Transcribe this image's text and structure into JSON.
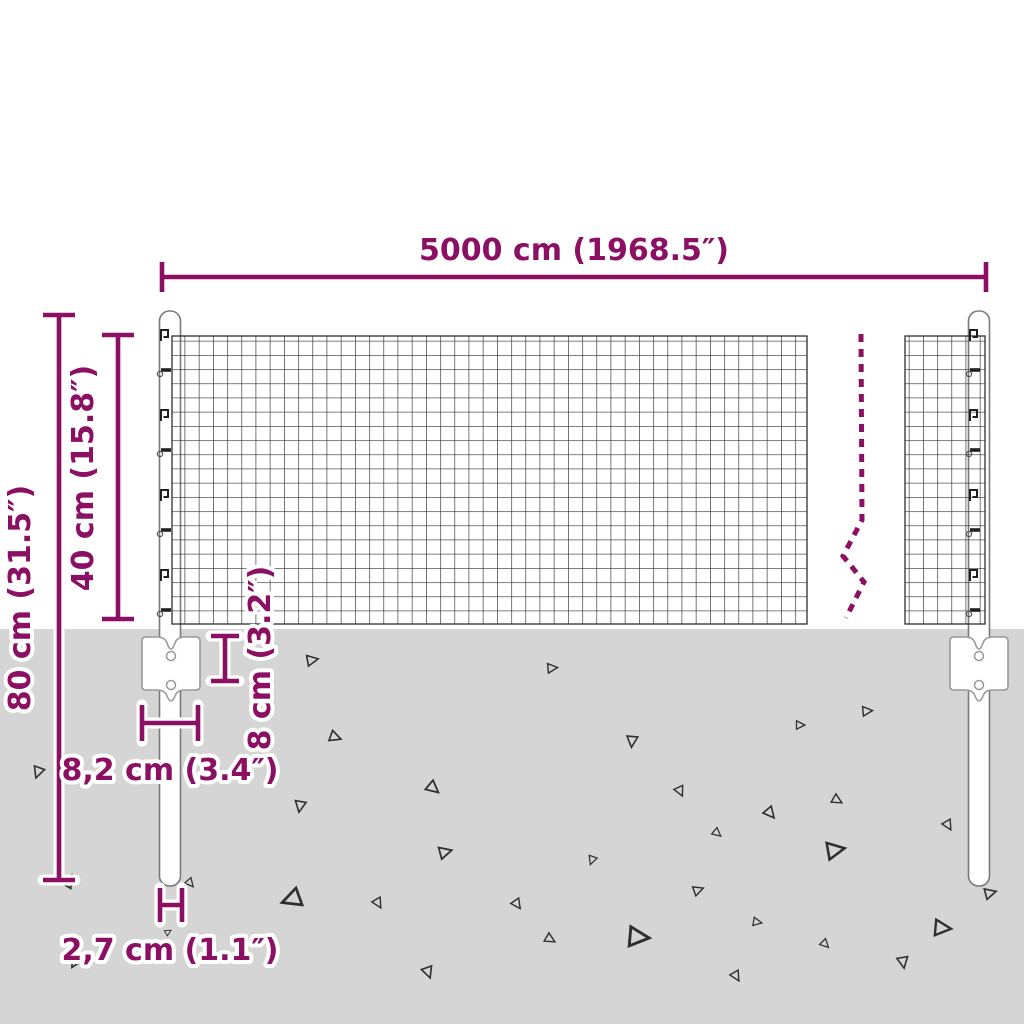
{
  "diagram": {
    "name": "wire-mesh-fence-dimension-diagram",
    "labels": {
      "total_width": "5000 cm (1968.5″)",
      "post_height": "80 cm (31.5″)",
      "mesh_height": "40 cm (15.8″)",
      "plate_height": "8 cm (3.2″)",
      "plate_width": "8,2 cm (3.4″)",
      "post_diameter": "2,7 cm (1.1″)"
    },
    "colors": {
      "dimension_accent": "#8B1063",
      "ground": "#D5D5D5",
      "mesh_line": "#2E2E2E",
      "outline_gray": "#7A7A7A"
    },
    "icon_names": [
      "fence-post-icon",
      "anchor-plate-icon",
      "wire-mesh-icon",
      "break-line-icon",
      "gravel-triangle-icon"
    ]
  }
}
